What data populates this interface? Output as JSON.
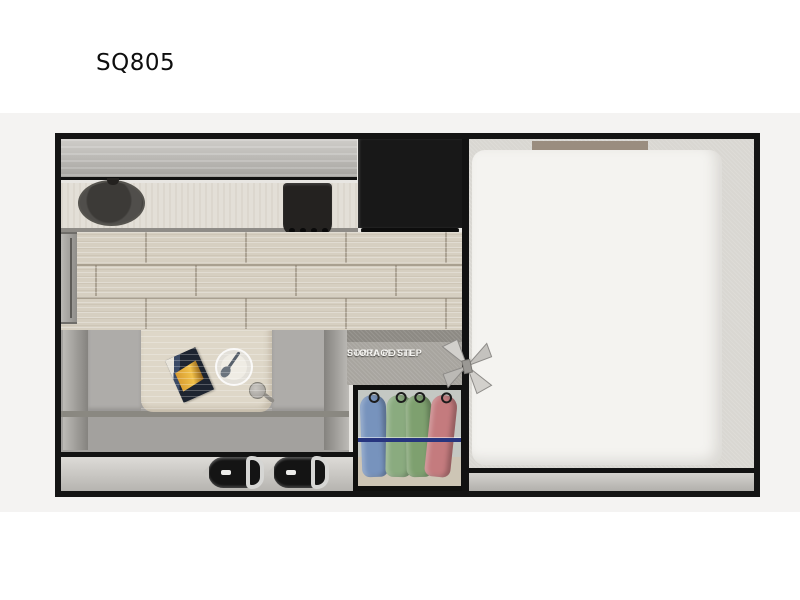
{
  "title": "SQ805",
  "floorplan": {
    "porta_potti": {
      "line1": "PORTA POTTI",
      "line2": "STORAGE STEP"
    },
    "fixtures": [
      "overhead-cabinet",
      "sink",
      "cooktop",
      "refrigerator",
      "countertop",
      "wood-floor",
      "entry-door",
      "dinette-sofa",
      "dinette-table",
      "magazine",
      "plate-with-spoon",
      "ladle",
      "porta-potti-storage-step",
      "wardrobe",
      "hanging-clothes",
      "vent-fan",
      "bed",
      "rear-step",
      "bumper"
    ],
    "colors": {
      "frame": "#141414",
      "background_band": "#f4f3f2",
      "cabinet_gray": "#b3b1ad",
      "counter": "#e3dfd7",
      "wood_floor": "#d6cfc1",
      "appliance_black": "#181818",
      "sofa_gray": "#a3a19e",
      "table_wood": "#ded7c8",
      "bed_white": "#f4f3f0",
      "bed_background": "#d9d7d2",
      "headboard_tan": "#9a8d7f",
      "wardrobe_rod_blue": "#27357f",
      "garment_blue": "#7793bd",
      "garment_green": "#8aab7f",
      "garment_pink": "#c47b7e"
    }
  }
}
